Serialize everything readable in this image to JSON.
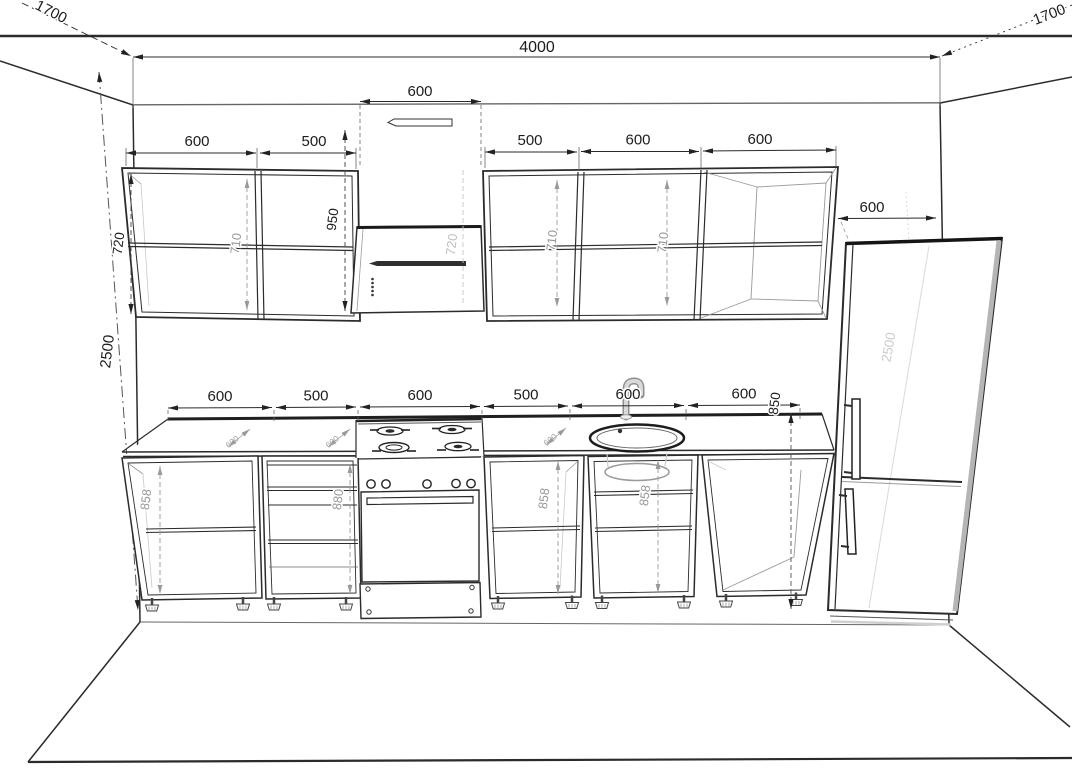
{
  "drawing": {
    "room": {
      "width": "4000",
      "left_depth": "1700",
      "right_depth": "1700",
      "height": "2500"
    },
    "upper_row": {
      "cab1_width": "600",
      "cab2_width": "500",
      "hood_width": "600",
      "cab3_width": "500",
      "cab4_width": "600",
      "cab5_width": "600",
      "cab_height": "720",
      "cab1_inner_height": "710",
      "hood_clearance": "950",
      "hood_height": "720",
      "cab3_inner_height": "710",
      "cab4_inner_height": "710"
    },
    "base_row": {
      "cab1_width": "600",
      "cab2_width": "500",
      "stove_width": "600",
      "cab3_width": "500",
      "sink_width": "600",
      "cab4_width": "600",
      "counter_height": "850",
      "cab1_inner_height": "858",
      "cab2_inner_height": "880",
      "cab3_inner_height": "858",
      "sink_inner_height": "858",
      "worktop_depth_1": "600",
      "worktop_depth_2": "600",
      "worktop_depth_3": "600"
    },
    "fridge": {
      "width": "600",
      "height": "2500"
    }
  }
}
